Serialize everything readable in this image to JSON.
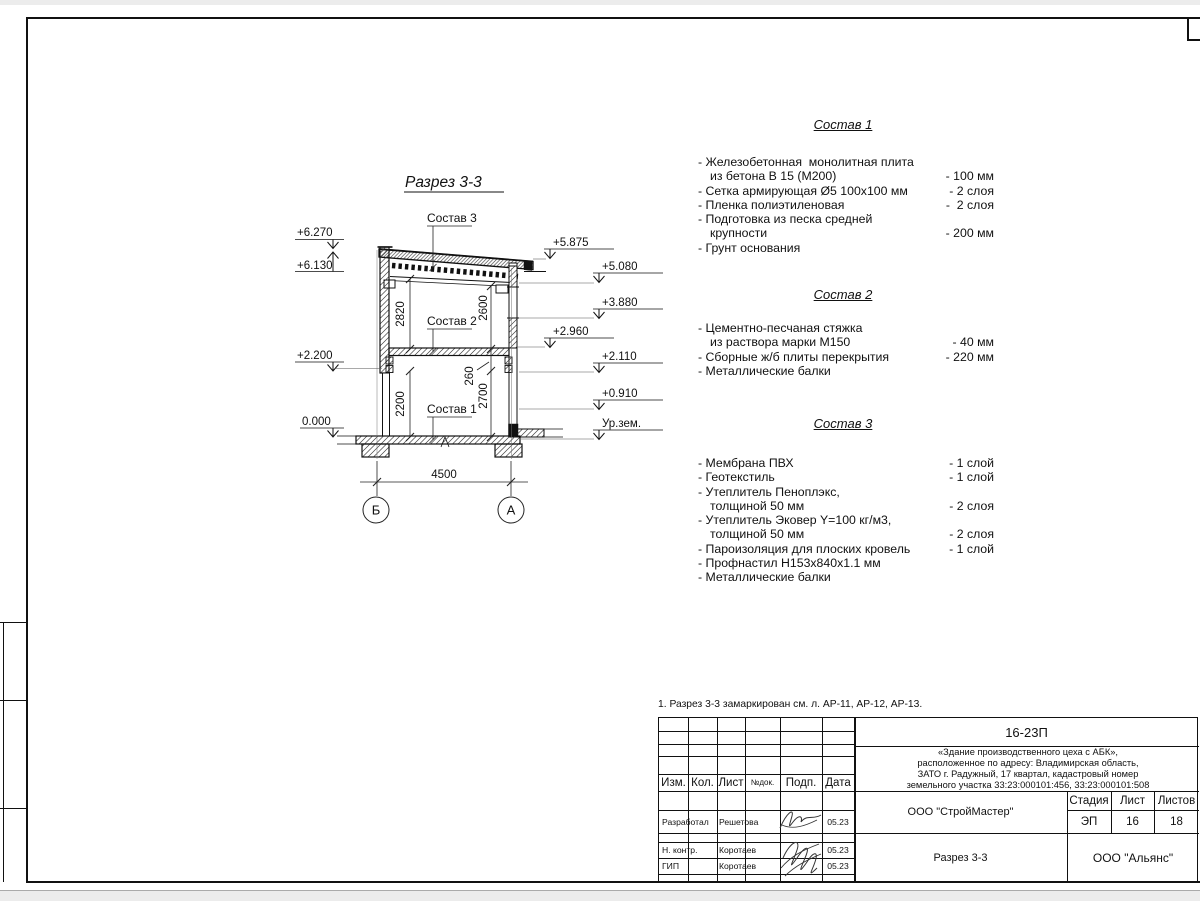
{
  "sheet": {
    "note": "1. Разрез 3-3 замаркирован см. л. АР-11, АР-12, АР-13."
  },
  "drawing": {
    "title": "Разрез 3-3",
    "callout_sostav_1": "Состав 1",
    "callout_sostav_2": "Состав 2",
    "callout_sostav_3": "Состав 3",
    "dim_2820": "2820",
    "dim_2600": "2600",
    "dim_2200": "2200",
    "dim_260": "260",
    "dim_2700": "2700",
    "dim_4500": "4500",
    "elev_left": [
      "+6.270",
      "+6.130",
      "+2.200",
      "0.000"
    ],
    "elev_right": [
      "+5.875",
      "+5.080",
      "+3.880",
      "+2.960",
      "+2.110",
      "+0.910",
      "Ур.зем."
    ],
    "axis_b": "Б",
    "axis_a": "А"
  },
  "compositions": [
    {
      "title": "Состав 1",
      "rows": [
        {
          "text": "- Железобетонная  монолитная плита",
          "value": ""
        },
        {
          "text": "из бетона В 15 (М200)",
          "value": "- 100 мм"
        },
        {
          "text": "- Сетка армирующая Ø5 100х100 мм",
          "value": "- 2 слоя"
        },
        {
          "text": "- Пленка полиэтиленовая",
          "value": "-  2 слоя"
        },
        {
          "text": "- Подготовка из песка средней",
          "value": ""
        },
        {
          "text": "крупности",
          "value": "- 200 мм"
        },
        {
          "text": "- Грунт основания",
          "value": ""
        }
      ]
    },
    {
      "title": "Состав 2",
      "rows": [
        {
          "text": "- Цементно-песчаная стяжка",
          "value": ""
        },
        {
          "text": "из раствора марки М150",
          "value": "- 40 мм"
        },
        {
          "text": "- Сборные ж/б плиты перекрытия",
          "value": "- 220 мм"
        },
        {
          "text": "- Металлические балки",
          "value": ""
        }
      ]
    },
    {
      "title": "Состав 3",
      "rows": [
        {
          "text": "- Мембрана ПВХ",
          "value": "- 1 слой"
        },
        {
          "text": "- Геотекстиль",
          "value": "- 1 слой"
        },
        {
          "text": "- Утеплитель Пеноплэкс,",
          "value": ""
        },
        {
          "text": "толщиной 50 мм",
          "value": "- 2 слоя"
        },
        {
          "text": "- Утеплитель Эковер Y=100 кг/м3,",
          "value": ""
        },
        {
          "text": "толщиной 50 мм",
          "value": "- 2 слоя"
        },
        {
          "text": "- Пароизоляция для плоских кровель",
          "value": "- 1 слой"
        },
        {
          "text": "- Профнастил Н153х840х1.1 мм",
          "value": ""
        },
        {
          "text": "- Металлические балки",
          "value": ""
        }
      ]
    }
  ],
  "titleblock": {
    "doc_number": "16-23П",
    "project_line1": "«Здание производственного цеха с АБК»,",
    "project_line2": "расположенное по адресу: Владимирская область,",
    "project_line3": "ЗАТО г. Радужный, 17 квартал, кадастровый номер",
    "project_line4": "земельного участка 33:23:000101:456, 33:23:000101:508",
    "col_izm": "Изм.",
    "col_kol": "Кол.",
    "col_list": "Лист",
    "col_ndoc": "№док.",
    "col_podp": "Подп.",
    "col_data": "Дата",
    "row1_role": "Разработал",
    "row1_name": "Решетова",
    "row1_date": "05.23",
    "row2_role": "Н. контр.",
    "row2_name": "Коротаев",
    "row2_date": "05.23",
    "row3_role": "ГИП",
    "row3_name": "Коротаев",
    "row3_date": "05.23",
    "org_design": "ООО \"СтройМастер\"",
    "stage_label": "Стадия",
    "sheet_label": "Лист",
    "sheets_label": "Листов",
    "stage_value": "ЭП",
    "sheet_value": "16",
    "sheets_value": "18",
    "sheet_title": "Разрез 3-3",
    "org_customer": "ООО \"Альянс\""
  }
}
